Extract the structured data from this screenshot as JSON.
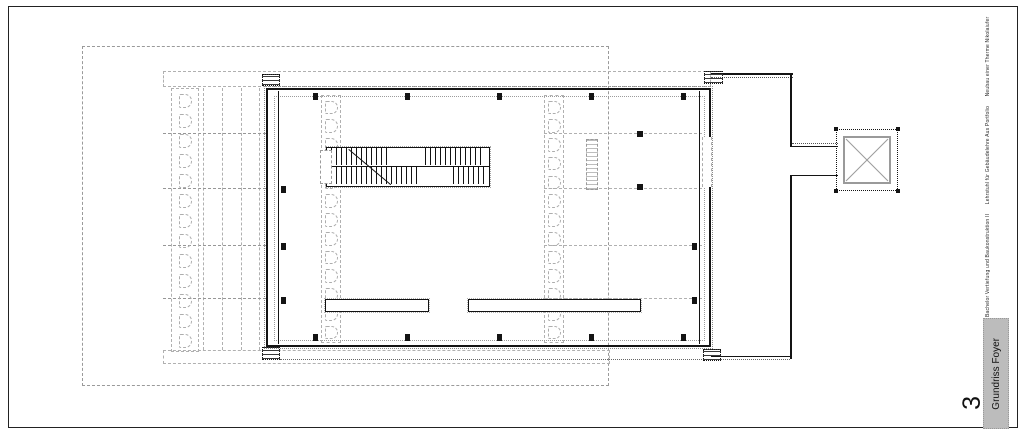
{
  "sheet": {
    "number": "3",
    "title": "Grundriss Foyer",
    "caption": "Bachelor Vertiefung und Baukonstruktion II      Lehrstuhl für Gebäudelehre Aus Portfolio      Neubau einer Therme Nikolaiufer"
  },
  "plan": {
    "room_modules_per_strip": 13,
    "colors": {
      "wall": "#141414",
      "ghost_gray": "#b0b0b0",
      "site_line": "#9a9a9a",
      "title_box_fill": "#bcbcbc"
    }
  }
}
